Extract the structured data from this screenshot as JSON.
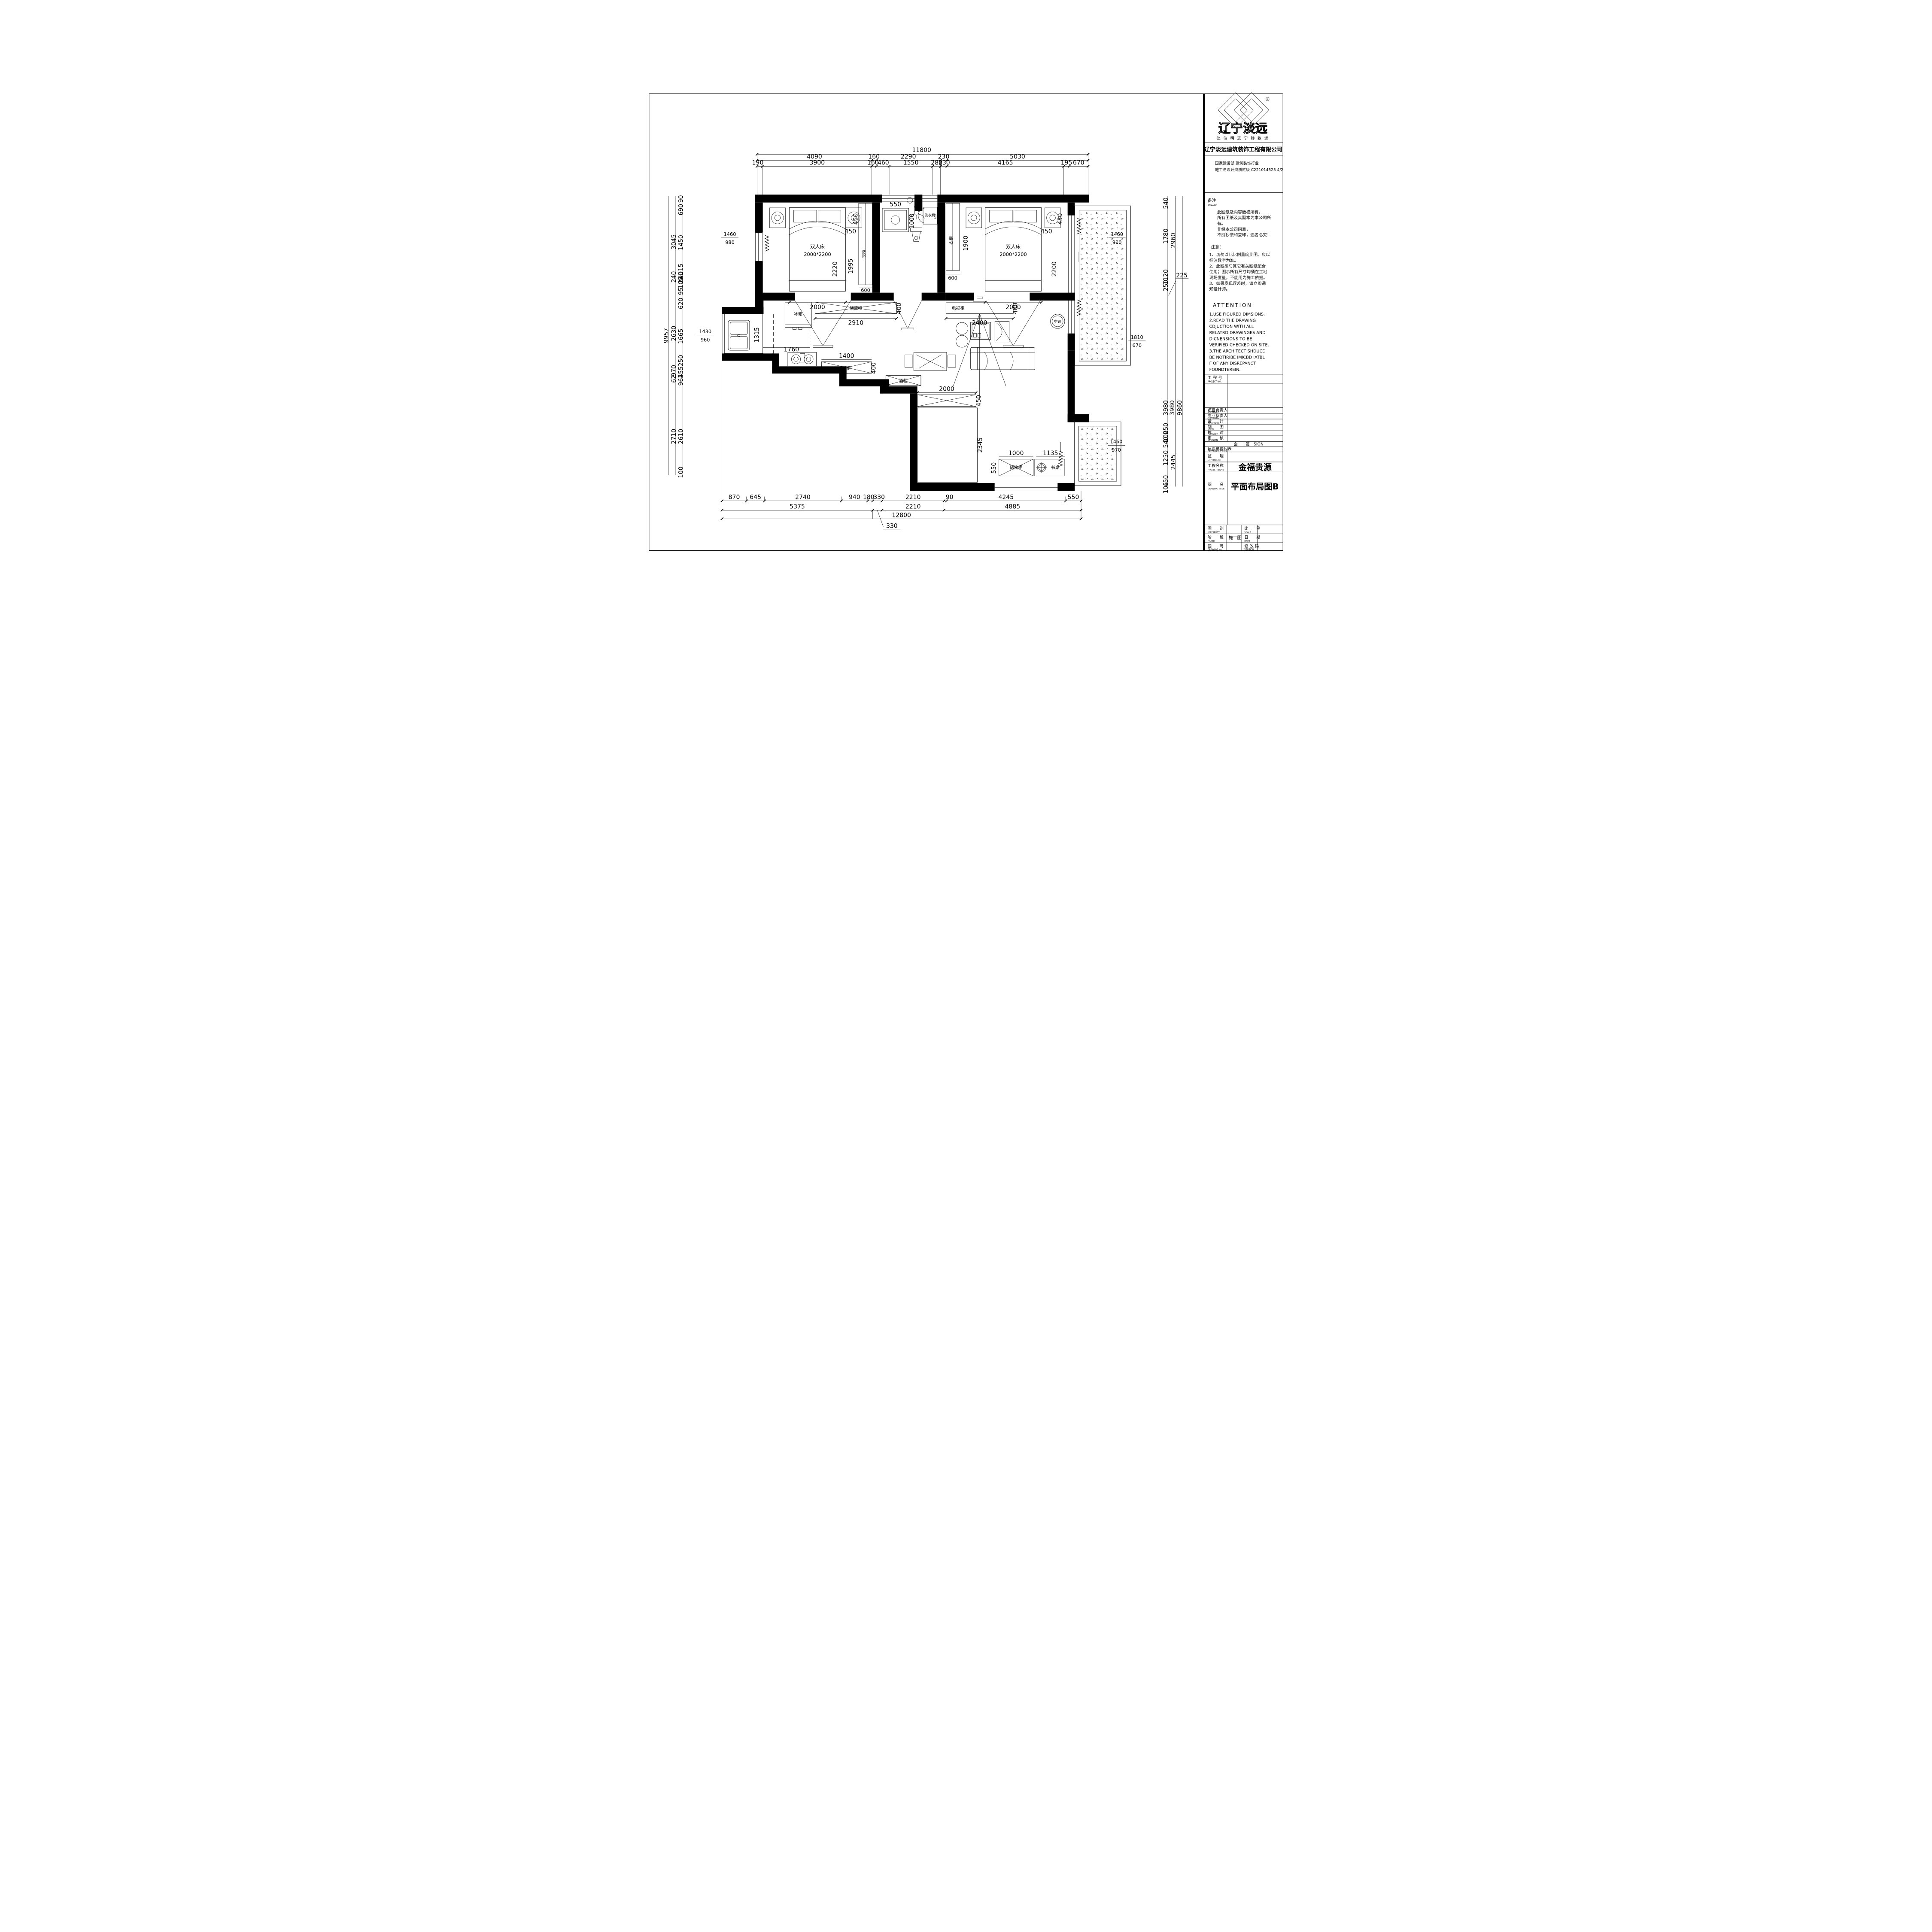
{
  "brand": {
    "name": "辽宁淡远",
    "reg": "®",
    "slogan": "淡 泊 明 志    宁 静 致 远",
    "company": "辽宁淡远建筑装饰工程有限公司",
    "cert1": "国家建设部  建筑装饰行业",
    "cert2": "施工与设计资质贰级   C221014525 4/2"
  },
  "remark": {
    "label": "备注",
    "label_en": "REMARK",
    "lines": [
      "此图纸及内容版权所有，",
      "所有图纸及其副本为本公司所",
      "有。",
      "非经本公司同意，",
      "不能抄袭和复印，违者必究！"
    ],
    "notice": "注意：",
    "notes": [
      "1、切勿以此比例量度此图。应以",
      "标注数字为准。",
      "2、此图须与其它有关图纸配合",
      "使用；图示所有尺寸均须在工地",
      "现场度量，不能用为施工依据。",
      "3、如果发现误差时，请立即通",
      "知设计师。"
    ],
    "attention": "ATTENTION",
    "attention_lines": [
      "1.USE FIGURED DIMSIONS.",
      "2.READ THE DRAWING",
      "CDJUCTION WITH ALL",
      "RELATRD DRAWINGES AND",
      "DICNENSIONS TO BE",
      "VERIFIED CHECKED ON SITE.",
      "3.THE ARCHITECT SHDUCD",
      "BE NOTIRIBE IMICBD IATBL",
      "F OF ANY DISREPANCT",
      "FOUNDTEREIN."
    ]
  },
  "titleblock": {
    "project_no": "工 程 号",
    "project_no_en": "PROJECT NO.",
    "approved1": "项目负责人",
    "approved1_en": "APPROVED",
    "approved2": "专业负责人",
    "approved2_en": "APPROVED",
    "designed": "设　　计",
    "designed_en": "DESIGNED",
    "draw": "制　　图",
    "draw_en": "DRAW",
    "checked": "校　　对",
    "checked_en": "CHEORED",
    "revision": "审　　核",
    "revision_en": "REVISION",
    "sign": "会　　签",
    "sign_en": "SIGN",
    "representative": "建设单位代表",
    "representative_en": "REPRESEN TATIVE",
    "supervisor": "监　　理",
    "supervisor_en": "SUPERVISOR",
    "project_name_label": "工程名称",
    "project_name_en": "PROJECT NAME",
    "project_name": "金福贵源",
    "drawing_title_label": "图　　名",
    "drawing_title_en": "DRAWING TITLE",
    "drawing_title": "平面布局图B",
    "speciality": "图　　别",
    "speciality_en": "SPECIALITY",
    "scale": "比　　例",
    "scale_en": "SCALE",
    "phase": "阶　　段",
    "phase_en": "PHASE",
    "phase_value": "施工图",
    "date": "日　　期",
    "date_en": "DATE",
    "drawing_no": "图　　号",
    "drawing_no_en": "DRAWING No.",
    "version": "修 改 码",
    "version_en": "VERSION"
  },
  "plan": {
    "labels": {
      "bed": "双人床",
      "bed_size": "2000*2200",
      "wardrobe": "衣柜",
      "washer": "洗衣机",
      "fridge": "冰箱",
      "storage_cabinet": "储藏柜",
      "shoe_cabinet": "鞋柜",
      "tv_cabinet": "电视柜",
      "ac": "空调",
      "wine_cabinet": "酒柜",
      "storage_cabinet2": "储物柜",
      "desk": "书桌"
    },
    "dims": {
      "top": {
        "total": "11800",
        "row2": [
          "4090",
          "160",
          "2290",
          "230",
          "5030"
        ],
        "row3": [
          "190",
          "3900",
          "160",
          "460",
          "1550",
          "280",
          "230",
          "4165",
          "195",
          "670"
        ]
      },
      "bottom": {
        "row1": [
          "870",
          "645",
          "2740",
          "940",
          "180",
          "330",
          "2210",
          "90",
          "4245",
          "550"
        ],
        "row2": [
          "5375",
          "2210",
          "4885"
        ],
        "total": "12800",
        "leader": "330"
      },
      "left": {
        "total": "9957",
        "middle": [
          "3045",
          "240",
          "2630",
          "970",
          "62",
          "2710"
        ],
        "inner": [
          "90",
          "690",
          "1450",
          "1015",
          "240",
          "100",
          "95",
          "620",
          "1665",
          "250",
          "455",
          "962",
          "2610",
          "100"
        ],
        "marker1": [
          "1460",
          "980"
        ],
        "marker2": [
          "1430",
          "960"
        ]
      },
      "right": {
        "col1": [
          "540",
          "1780",
          "1120",
          "250"
        ],
        "col2": [
          "2960"
        ],
        "cluster": [
          "3980",
          "3980",
          "9860"
        ],
        "col1b": [
          "250",
          "100",
          "540",
          "1250",
          "450",
          "105"
        ],
        "col2b": [
          "2445"
        ],
        "leader": "225",
        "marker1": [
          "1460",
          "900"
        ],
        "marker2": [
          "1810",
          "670"
        ],
        "marker3": [
          "1460",
          "970"
        ]
      },
      "rooms": {
        "bed1": [
          "450",
          "450",
          "2220",
          "1995",
          "600",
          "2000"
        ],
        "bath": [
          "550",
          "1000"
        ],
        "bed2": [
          "450",
          "450",
          "2200",
          "1900",
          "600",
          "2000"
        ],
        "kitchen": [
          "1315",
          "1760",
          "2910",
          "400",
          "1400",
          "400"
        ],
        "living": [
          "2400",
          "400"
        ],
        "study": [
          "2000",
          "450",
          "2345",
          "1000",
          "1135",
          "550"
        ]
      }
    }
  }
}
